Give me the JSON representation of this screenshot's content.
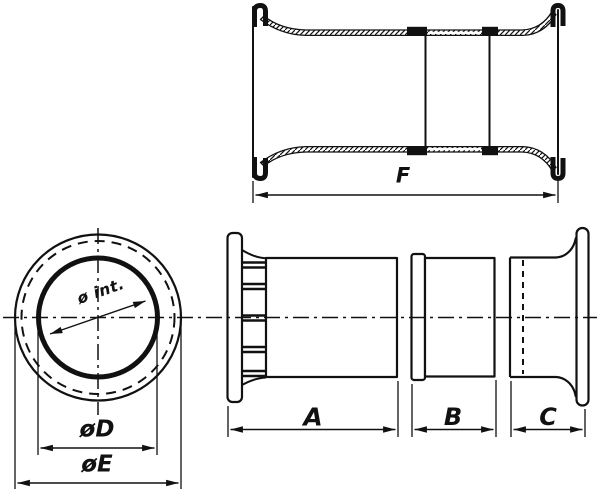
{
  "drawing": {
    "background_color": "#ffffff",
    "line_color": "#111111",
    "views": {
      "assembled_side_view": {
        "name": "assembled tube profile (top view)",
        "dimension_f_label": "F"
      },
      "front_view": {
        "name": "front circular view",
        "inner_diameter_label": "ø int.",
        "diameter_d_label": "øD",
        "diameter_e_label": "øE"
      },
      "exploded_side_view": {
        "name": "exploded parts side view",
        "part_a_label": "A",
        "part_b_label": "B",
        "part_c_label": "C"
      }
    }
  }
}
